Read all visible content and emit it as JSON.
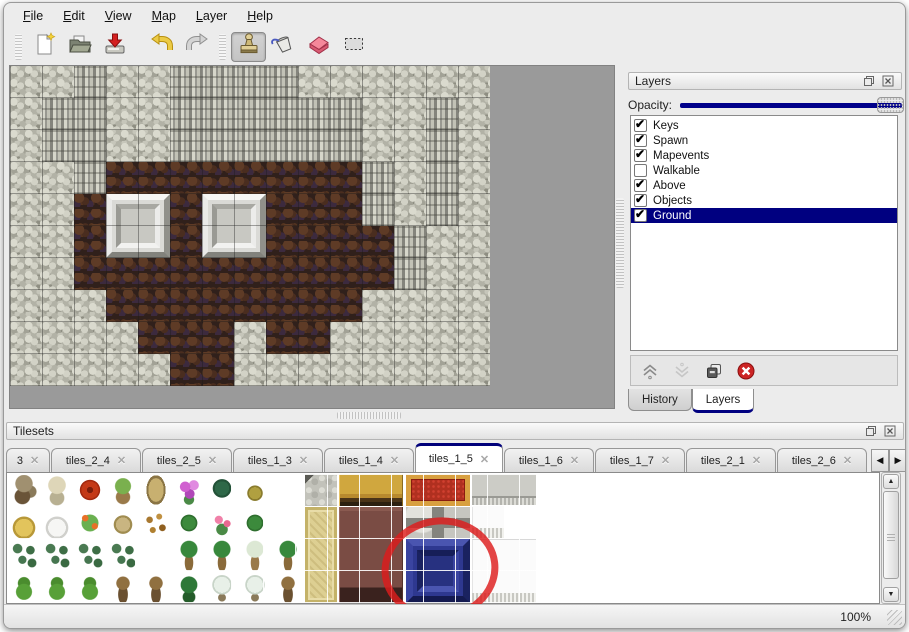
{
  "colors": {
    "accent": "#000080",
    "selection": "#000080",
    "annotation_red": "#dd1c1c",
    "canvas_gray": "#9a9a9a"
  },
  "menu": {
    "items": [
      {
        "label": "File"
      },
      {
        "label": "Edit"
      },
      {
        "label": "View"
      },
      {
        "label": "Map"
      },
      {
        "label": "Layer"
      },
      {
        "label": "Help"
      }
    ]
  },
  "toolbar": {
    "groups": [
      {
        "buttons": [
          {
            "icon": "new-file",
            "active": false
          },
          {
            "icon": "open-folder",
            "active": false
          },
          {
            "icon": "save",
            "active": false
          },
          {
            "icon": "undo",
            "active": false
          },
          {
            "icon": "redo",
            "active": false
          }
        ]
      },
      {
        "buttons": [
          {
            "icon": "stamp-tool",
            "active": true
          },
          {
            "icon": "fill-bucket-tool",
            "active": false
          },
          {
            "icon": "eraser-tool",
            "active": false
          },
          {
            "icon": "rect-select-tool",
            "active": false
          }
        ]
      }
    ]
  },
  "map": {
    "tile_size": 32,
    "legend": {
      "R": "rock",
      "C": "cliff",
      "F": "floor"
    },
    "grid": [
      "RRCRRCCCCRRRRRR",
      "RCCRRCCCCCCRRCR",
      "RCCRRCCCCCCRRCR",
      "RRCFFFFFFFFCRCR",
      "RRFFFFFFFFFCRCR",
      "RRFFFFFFFFFFCRR",
      "RRFFFFFFFFFFCRR",
      "RRRFFFFFFFFRRRR",
      "RRRRFFFRFFRRRRR",
      "RRRRRFFRRRRRRRR"
    ],
    "pillars": [
      {
        "x": 96,
        "y": 128
      },
      {
        "x": 192,
        "y": 128
      }
    ]
  },
  "layers_panel": {
    "title": "Layers",
    "opacity_label": "Opacity:",
    "opacity_value": 1.0,
    "layers": [
      {
        "name": "Keys",
        "checked": true,
        "selected": false
      },
      {
        "name": "Spawn",
        "checked": true,
        "selected": false
      },
      {
        "name": "Mapevents",
        "checked": true,
        "selected": false
      },
      {
        "name": "Walkable",
        "checked": false,
        "selected": false
      },
      {
        "name": "Above",
        "checked": true,
        "selected": false
      },
      {
        "name": "Objects",
        "checked": true,
        "selected": false
      },
      {
        "name": "Ground",
        "checked": true,
        "selected": true
      }
    ],
    "buttons": [
      {
        "icon": "move-up",
        "enabled": true
      },
      {
        "icon": "move-down",
        "enabled": false
      },
      {
        "icon": "duplicate-layer",
        "enabled": true
      },
      {
        "icon": "delete-layer",
        "enabled": true
      }
    ],
    "tabs": [
      {
        "label": "History",
        "active": false
      },
      {
        "label": "Layers",
        "active": true
      }
    ]
  },
  "tilesets_panel": {
    "title": "Tilesets",
    "tabs": [
      {
        "label": "3",
        "active": false,
        "clipped": true
      },
      {
        "label": "tiles_2_4",
        "active": false
      },
      {
        "label": "tiles_2_5",
        "active": false
      },
      {
        "label": "tiles_1_3",
        "active": false
      },
      {
        "label": "tiles_1_4",
        "active": false
      },
      {
        "label": "tiles_1_5",
        "active": true
      },
      {
        "label": "tiles_1_6",
        "active": false
      },
      {
        "label": "tiles_1_7",
        "active": false
      },
      {
        "label": "tiles_2_1",
        "active": false
      },
      {
        "label": "tiles_2_6",
        "active": false
      }
    ],
    "tab_scroll": [
      {
        "icon": "scroll-left"
      },
      {
        "icon": "scroll-right"
      }
    ],
    "sprite_grid": [
      [
        "treeDead",
        "treePale",
        "flowerRed",
        "stump",
        "trunkTan",
        "flowerPurple",
        "fernDark",
        "plantSpider",
        ""
      ],
      [
        "hay",
        "snowMound",
        "flowerPatch",
        "dryGrass",
        "leaves",
        "lilyPad",
        "roses",
        "lilyPad",
        ""
      ],
      [
        "bushes",
        "bushes",
        "bushes",
        "bushes",
        "",
        "palm",
        "palm",
        "snowPalm",
        "palm"
      ],
      [
        "pineBush",
        "pineBush",
        "pineBush",
        "twistTree",
        "twistTree",
        "treeGreen",
        "snowTree",
        "snowTree",
        "twistTree"
      ]
    ],
    "blocks": [
      {
        "type": "stone",
        "x": 298,
        "y": 1,
        "w": 32,
        "h": 32
      },
      {
        "type": "gold",
        "x": 332,
        "y": 1,
        "w": 64,
        "h": 32
      },
      {
        "type": "carpet",
        "x": 399,
        "y": 1,
        "w": 64,
        "h": 32
      },
      {
        "type": "curtain",
        "x": 465,
        "y": 1,
        "w": 64,
        "h": 31
      },
      {
        "type": "khaki",
        "x": 298,
        "y": 34,
        "w": 32,
        "h": 96
      },
      {
        "type": "maroon",
        "x": 332,
        "y": 34,
        "w": 64,
        "h": 96
      },
      {
        "type": "grayblocks",
        "x": 399,
        "y": 34,
        "w": 64,
        "h": 31
      },
      {
        "type": "whitefringe",
        "x": 465,
        "y": 33,
        "w": 32,
        "h": 32
      },
      {
        "type": "blue",
        "x": 399,
        "y": 66,
        "w": 64,
        "h": 64
      },
      {
        "type": "whitebig",
        "x": 465,
        "y": 66,
        "w": 64,
        "h": 64
      }
    ],
    "annotation": {
      "shape": "red-circle",
      "cx": 430,
      "cy": 93,
      "rx": 55,
      "ry": 48
    }
  },
  "status_bar": {
    "zoom": "100%"
  }
}
